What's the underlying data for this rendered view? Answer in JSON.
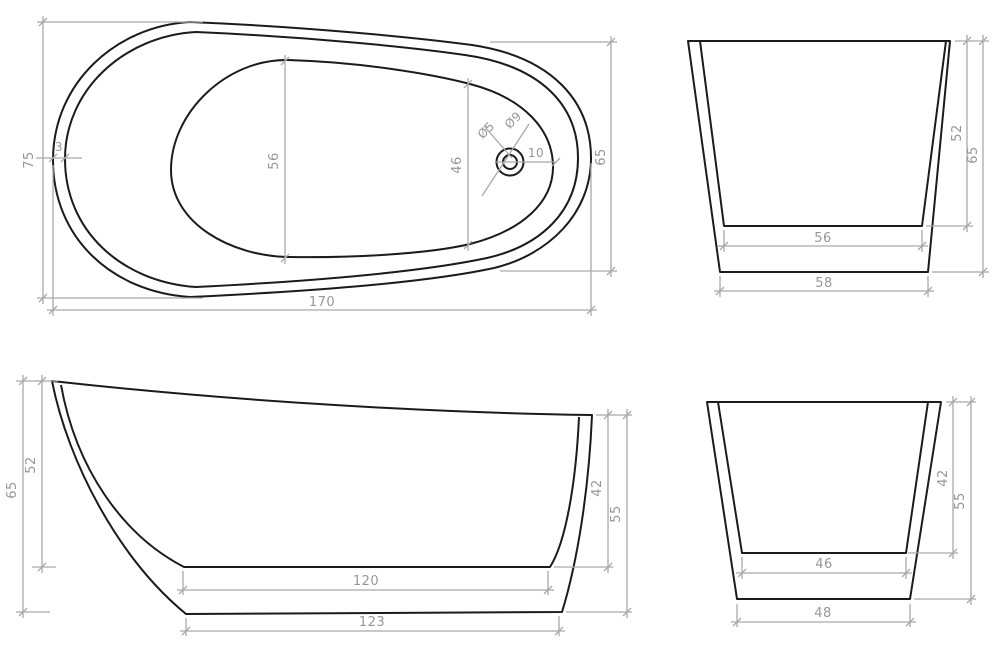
{
  "colors": {
    "outline": "#1b1b1b",
    "dimension": "#a9a9a9",
    "dim_text": "#979797",
    "background": "#ffffff"
  },
  "views": {
    "plan": {
      "length": "170",
      "width_left": "75",
      "width_right": "65",
      "basin_width_mid": "56",
      "basin_width_foot": "46",
      "wall_thickness": "3",
      "drain_inner_dia": "Ø5",
      "drain_outer_dia": "Ø9",
      "drain_offset": "10"
    },
    "end_head": {
      "basin_depth": "52",
      "overall_height": "65",
      "basin_bottom_width": "56",
      "base_width": "58"
    },
    "side": {
      "overall_height_back": "65",
      "basin_depth_back": "52",
      "basin_depth_front": "42",
      "overall_height_front": "55",
      "basin_floor_length": "120",
      "base_length": "123"
    },
    "end_foot": {
      "basin_depth": "42",
      "overall_height": "55",
      "basin_bottom_width": "46",
      "base_width": "48"
    }
  }
}
